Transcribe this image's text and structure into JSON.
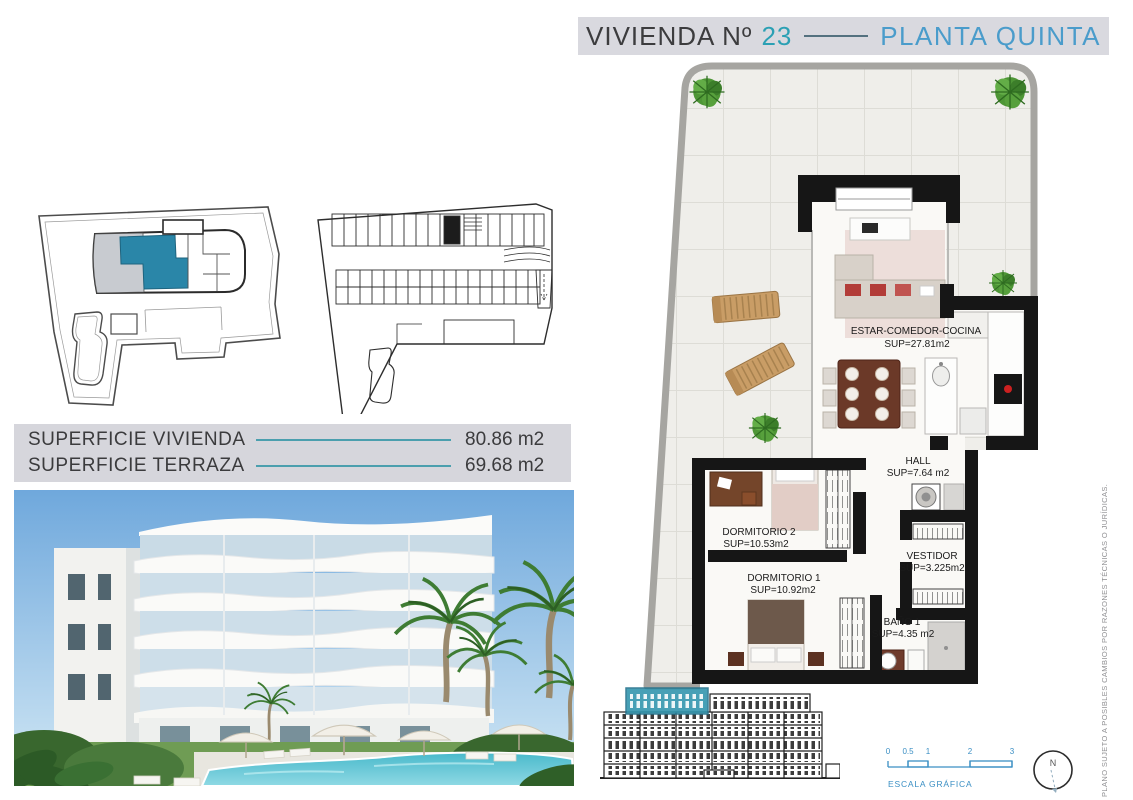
{
  "title": {
    "vivienda_label": "VIVIENDA Nº",
    "number": "23",
    "planta": "PLANTA QUINTA"
  },
  "surfaces": {
    "rows": [
      {
        "label": "SUPERFICIE VIVIENDA",
        "value": "80.86 m2"
      },
      {
        "label": "SUPERFICIE TERRAZA",
        "value": "69.68 m2"
      }
    ]
  },
  "floorplan": {
    "rooms": [
      {
        "name": "ESTAR-COMEDOR-COCINA",
        "area": "SUP=27.81m2"
      },
      {
        "name": "HALL",
        "area": "SUP=7.64  m2"
      },
      {
        "name": "DORMITORIO 2",
        "area": "SUP=10.53m2"
      },
      {
        "name": "VESTIDOR",
        "area": "SUP=3.225m2"
      },
      {
        "name": "DORMITORIO 1",
        "area": "SUP=10.92m2"
      },
      {
        "name": "BAÑO 1",
        "area": "SUP=4.35  m2"
      }
    ]
  },
  "scale_bar": {
    "ticks": [
      "0",
      "0.5",
      "1",
      "2",
      "3"
    ],
    "label": "ESCALA GRÁFICA"
  },
  "compass": {
    "north_label": "N"
  },
  "disclaimer": "PLANO SUJETO A POSIBLES CAMBIOS POR RAZONES TÉCNICAS O JURÍDICAS.",
  "colors": {
    "accent_teal": "#2BA0B4",
    "accent_blue": "#4A9CCB",
    "band_bg": "#D7D7DD",
    "scale_blue": "#3B8FC4",
    "highlight_teal": "#2E93AD"
  }
}
